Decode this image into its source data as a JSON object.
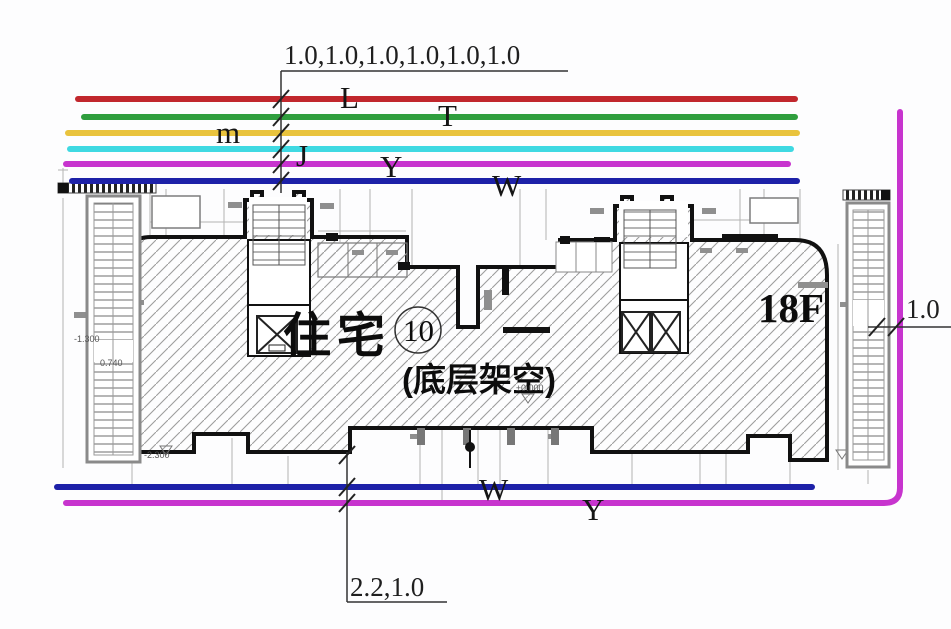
{
  "annotations": {
    "top_dimension": "1.0,1.0,1.0,1.0,1.0,1.0",
    "bottom_dimension": "2.2,1.0",
    "right_dimension": "1.0"
  },
  "pipelines": {
    "top": [
      {
        "label": "L",
        "color": "#c1272d"
      },
      {
        "label": "T",
        "color": "#2f9e3e"
      },
      {
        "label": "m",
        "color": "#e9c33d"
      },
      {
        "label": "J",
        "color": "#3fd9e2"
      },
      {
        "label": "Y",
        "color": "#c734ce"
      },
      {
        "label": "W",
        "color": "#1d21a8"
      }
    ],
    "bottom": [
      {
        "label": "W",
        "color": "#1d21a8"
      },
      {
        "label": "Y",
        "color": "#c734ce"
      }
    ]
  },
  "building": {
    "name": "住宅",
    "unit_circle": "10",
    "note": "(底层架空)",
    "floors": "18F"
  },
  "elevation_marks": [
    {
      "text": "±0.000"
    },
    {
      "text": "-1.300"
    },
    {
      "text": "0.740"
    },
    {
      "text": "-2.300"
    }
  ]
}
